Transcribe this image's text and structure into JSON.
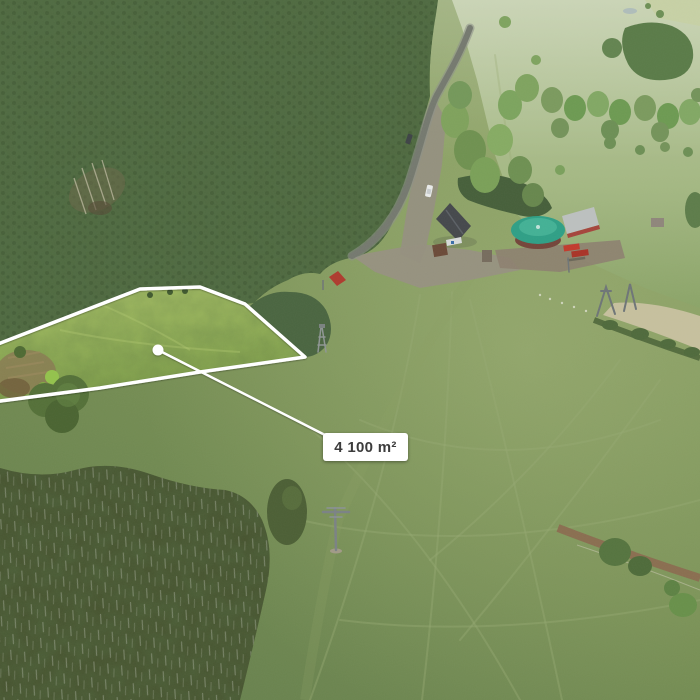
{
  "meta": {
    "type": "aerial-drone-photograph",
    "subject": "Grass building plot outlined in white on a hillside meadow beside forest, an access road, a ski-lift base with buildings and pylons"
  },
  "annotation": {
    "area_label": "4 100 m²",
    "outline_color": "#ffffff",
    "marker_color": "#ffffff",
    "label_background": "#ffffff",
    "label_text_color": "#3c3c3c"
  },
  "scene": {
    "palette": {
      "parcel_grass": "#9db958",
      "meadow": "#7c9257",
      "pale_meadow": "#b7c59c",
      "conifer_forest": "#4f6a41",
      "birch_grove": "#46522e",
      "road_asphalt": "#75796f",
      "gravel": "#95907f",
      "pavilion_roof": "#2f9f86",
      "barn_roof": "#bcc0bf",
      "red_vehicles": "#c23a2c"
    },
    "landmarks": [
      "conifer-forest",
      "access-road",
      "gravel-parking",
      "guesthouse",
      "round-pavilion",
      "storage-barn",
      "snow-groomers",
      "ski-lift-pylons",
      "highlighted-parcel",
      "garden-patch",
      "lone-tree",
      "birch-grove",
      "meadow-paths",
      "hedge-and-stubble-field",
      "dirt-track"
    ]
  }
}
